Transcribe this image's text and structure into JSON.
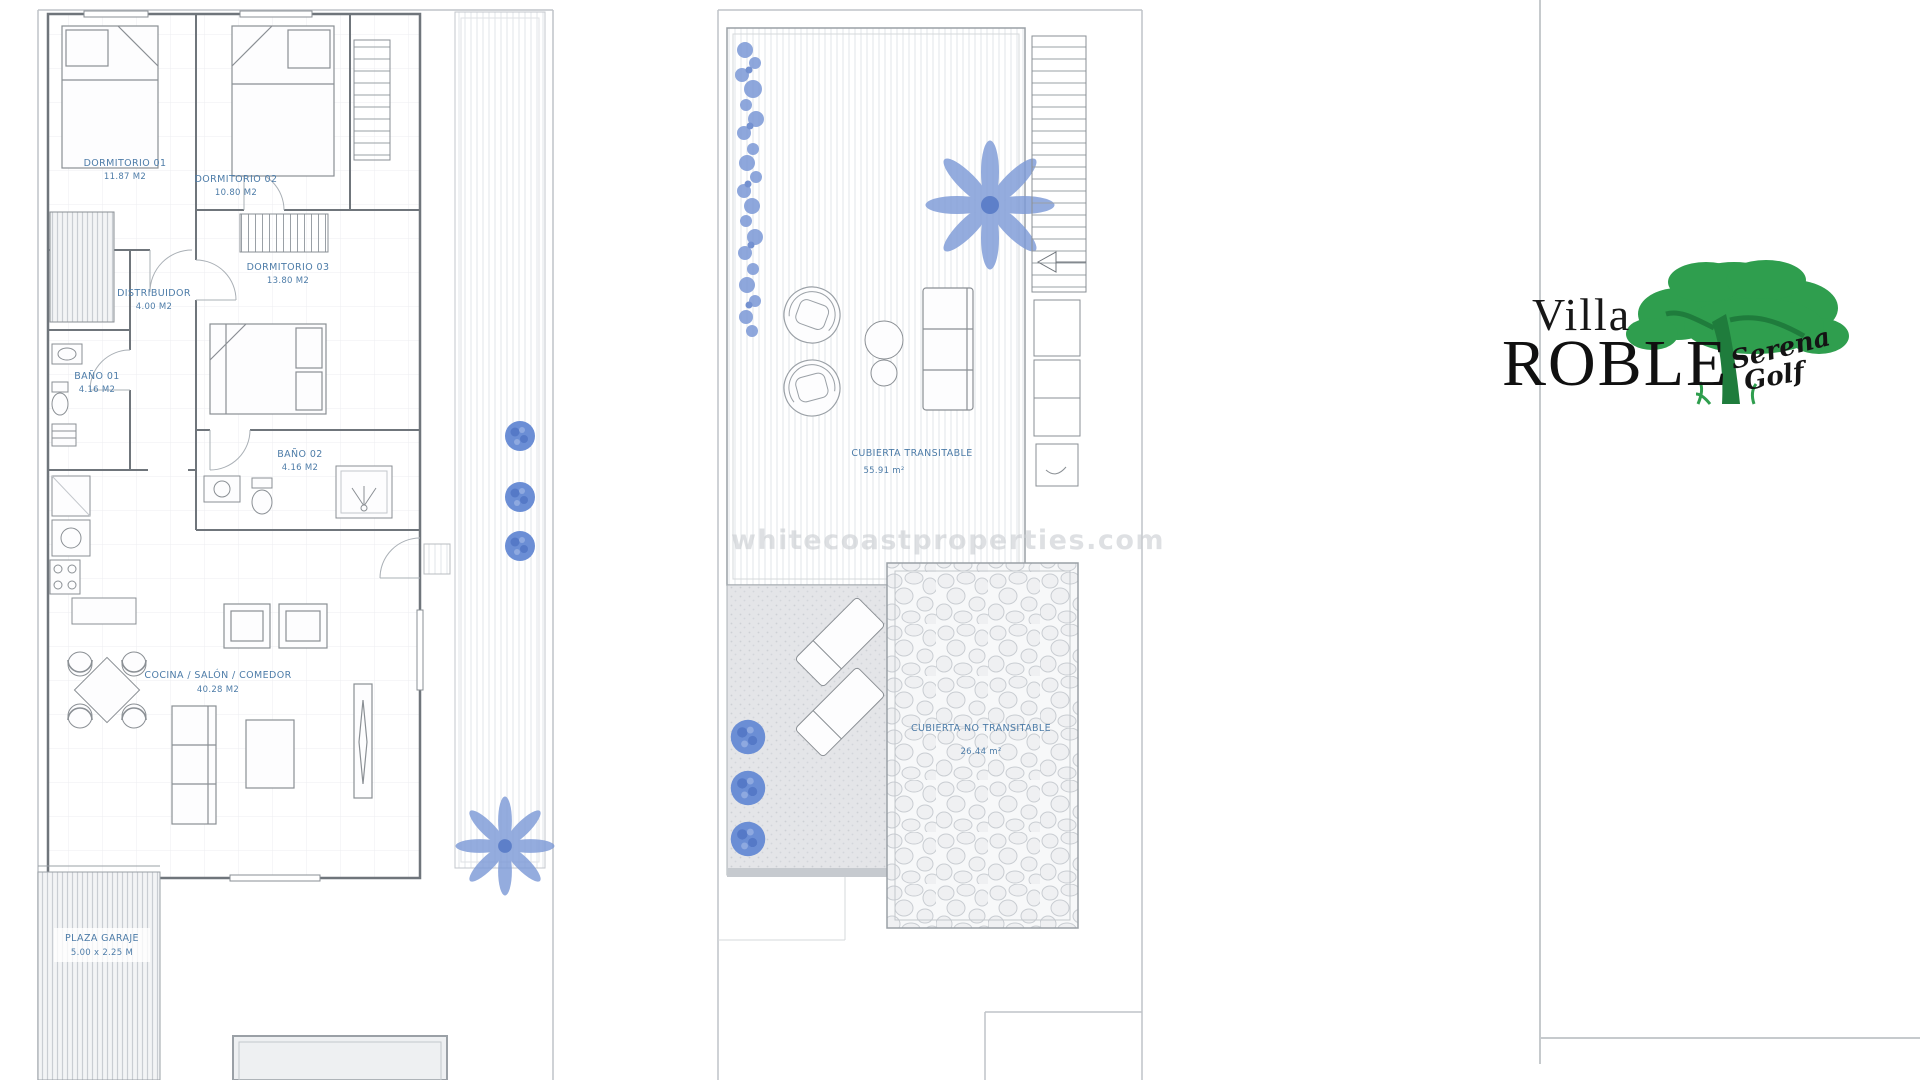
{
  "watermark": {
    "text": "whitecoastproperties.com"
  },
  "logo": {
    "villa": "Villa",
    "roble": "ROBLE",
    "serena": "Serena",
    "golf": "Golf",
    "green": "#2f9e4e",
    "text_color": "#141414"
  },
  "colors": {
    "label_blue": "#4d7ca8",
    "plant_blue": "#6b8ed5",
    "wall_gray": "#6f757b",
    "light_line": "#c6cacd",
    "terrace_gray": "#e4e5e8"
  },
  "ground_floor": {
    "rooms": [
      {
        "id": "dormitorio-01",
        "name": "DORMITORIO 01",
        "area": "11.87 M2"
      },
      {
        "id": "dormitorio-02",
        "name": "DORMITORIO 02",
        "area": "10.80 M2"
      },
      {
        "id": "dormitorio-03",
        "name": "DORMITORIO 03",
        "area": "13.80 M2"
      },
      {
        "id": "distribuidor",
        "name": "DISTRIBUIDOR",
        "area": "4.00 M2"
      },
      {
        "id": "bano-01",
        "name": "BAÑO 01",
        "area": "4.16 M2"
      },
      {
        "id": "bano-02",
        "name": "BAÑO 02",
        "area": "4.16 M2"
      },
      {
        "id": "cocina-salon-comedor",
        "name": "COCINA / SALÓN / COMEDOR",
        "area": "40.28 M2"
      },
      {
        "id": "plaza-garaje",
        "name": "PLAZA GARAJE",
        "area": "5.00 x 2.25 M"
      }
    ]
  },
  "roof": {
    "areas": [
      {
        "id": "cubierta-transitable",
        "name": "CUBIERTA TRANSITABLE",
        "area": "55.91 m²"
      },
      {
        "id": "cubierta-no-transitable",
        "name": "CUBIERTA NO TRANSITABLE",
        "area": "26.44 m²"
      }
    ]
  }
}
